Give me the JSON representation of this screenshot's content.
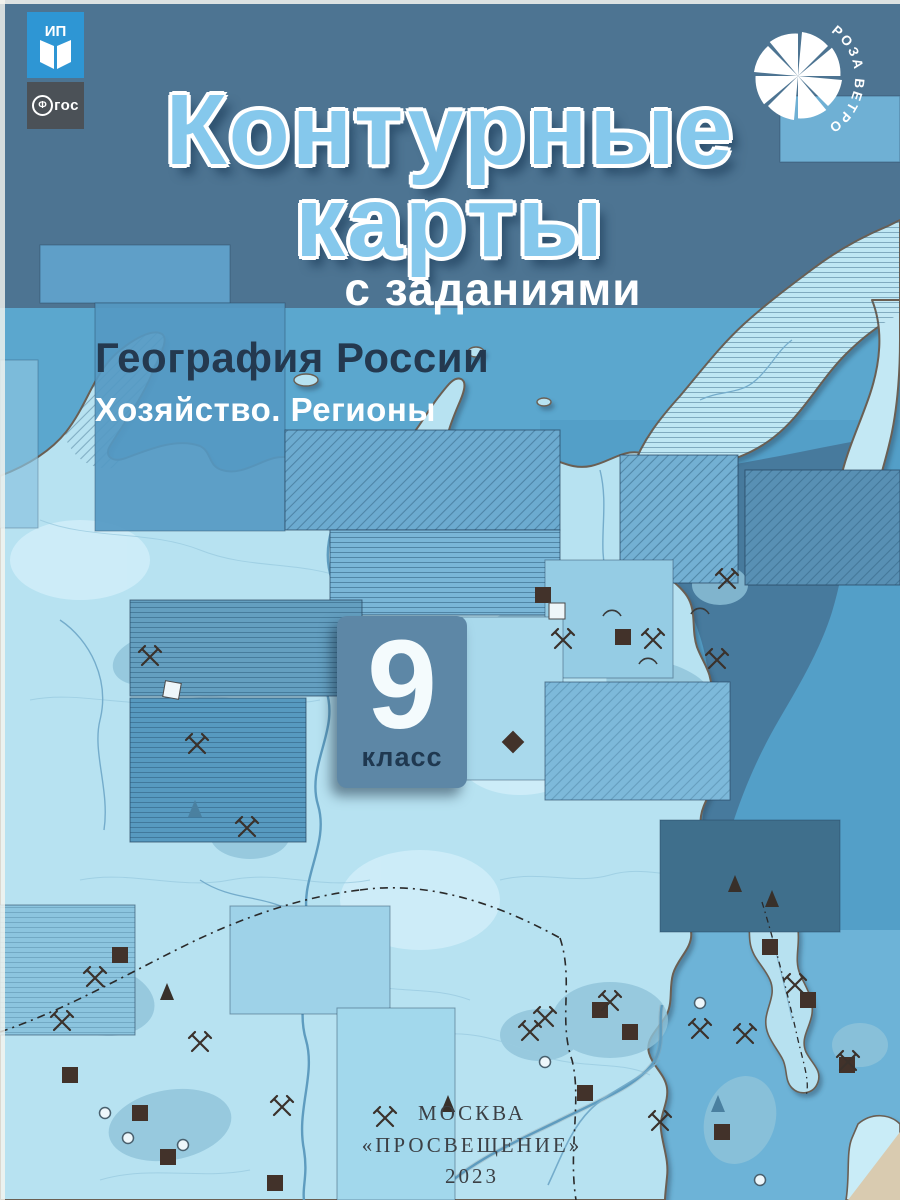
{
  "cover": {
    "title": {
      "line1": "Контурные",
      "line2": "карты"
    },
    "subtitle": "с заданиями",
    "series": {
      "title": "География России",
      "subtitle": "Хозяйство. Регионы"
    },
    "grade": {
      "number": "9",
      "label": "класс"
    },
    "imprint": {
      "city": "МОСКВА",
      "publisher": "«ПРОСВЕЩЕНИЕ»",
      "year": "2023"
    },
    "logos": {
      "publisher": {
        "name": "Просвещение",
        "mark": "ИП",
        "icon": "open-book-icon"
      },
      "fgos": {
        "initial": "Ф",
        "rest": "гос",
        "full": "ФГОС"
      },
      "wind_rose": {
        "text": "РОЗА ВЕТРОВ",
        "icon": "wind-rose-pinwheel-icon"
      }
    },
    "colors": {
      "top_band": "#4d7492",
      "title_fill": "#85c8ec",
      "title_outline": "#ffffff",
      "sea": "#58a5cc",
      "sea_dark": "#47789b",
      "land": "#b7e2f1",
      "land_pale": "#cdeef9",
      "badge": "#5d87a6",
      "navy_text": "#24394f",
      "imprint_text": "#3c4045",
      "publisher_logo_bg": "#2e96d4",
      "fgos_bg": "#4b5157"
    },
    "map_symbols": [
      "crossed-hammers-icon",
      "ore-square-icon",
      "cone-icon",
      "circle-icon",
      "crescent-arc-icon",
      "railway-dash-line",
      "river-line",
      "contour-line"
    ]
  }
}
